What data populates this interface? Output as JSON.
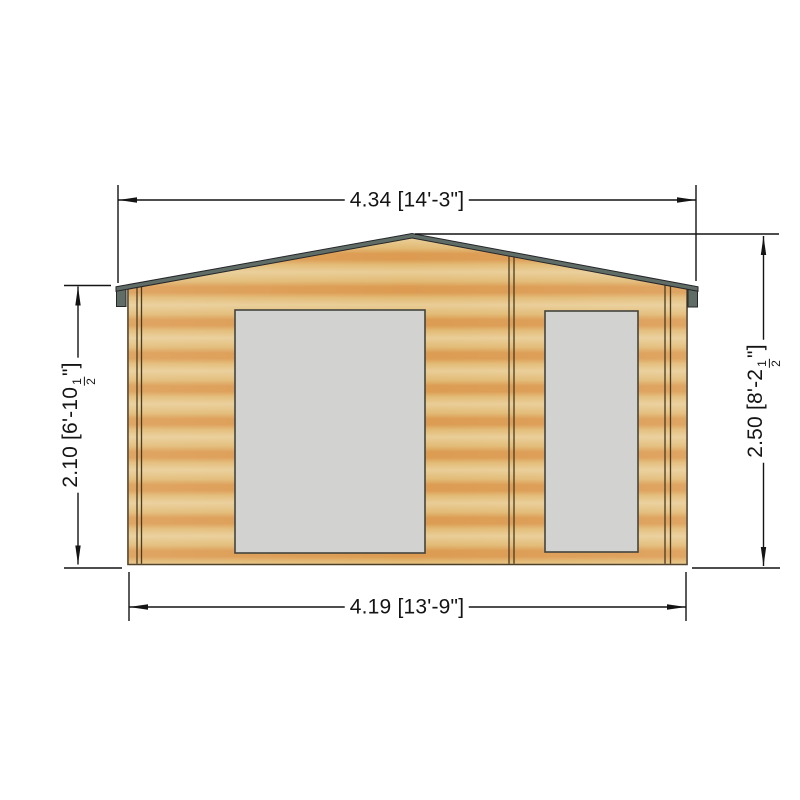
{
  "dimensions": {
    "top": {
      "label": "4.34 [14'-3\"]"
    },
    "bottom": {
      "label": "4.19 [13'-9\"]"
    },
    "left": {
      "prefix": "2.10 [6'-10",
      "fraction_numerator": "1",
      "fraction_denominator": "2",
      "suffix": "\"]"
    },
    "right": {
      "prefix": "2.50 [8'-2",
      "fraction_numerator": "1",
      "fraction_denominator": "2",
      "suffix": "\"]"
    }
  },
  "colors": {
    "wood_light": "#e9cd96",
    "wood_mid": "#e2ba74",
    "wood_dark": "#dc9b51",
    "wall_outline": "#4a3b24",
    "roof_fascia": "#5f6d66",
    "roof_outline": "#26262a",
    "window_fill": "#d2d2d0",
    "window_border": "#44443e",
    "dimension_line": "#141414"
  }
}
